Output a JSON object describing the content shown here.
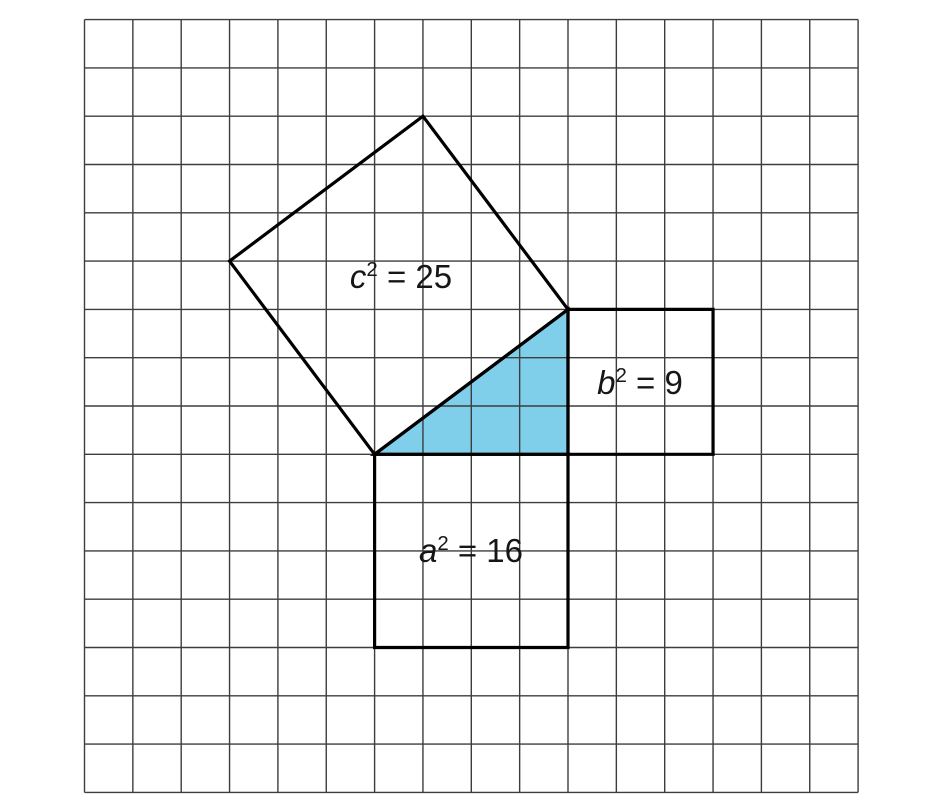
{
  "figure": {
    "grid": {
      "cols": 16,
      "rows": 16,
      "cell_w": 48.35,
      "cell_h": 48.3,
      "origin_x": 84.5,
      "origin_y": 19.6,
      "line_color": "#3d3d3d",
      "line_width": 1.4,
      "background": "#ffffff"
    },
    "style": {
      "outline_color": "#000000",
      "outline_width": 3.2,
      "triangle_fill": "#7FCFEA",
      "text_color": "#161616"
    },
    "shapes": {
      "c_square": [
        [
          6,
          9
        ],
        [
          3,
          5
        ],
        [
          7,
          2
        ],
        [
          10,
          6
        ]
      ],
      "b_square": [
        [
          10,
          6
        ],
        [
          13,
          6
        ],
        [
          13,
          9
        ],
        [
          10,
          9
        ]
      ],
      "a_square": [
        [
          6,
          9
        ],
        [
          10,
          9
        ],
        [
          10,
          13
        ],
        [
          6,
          13
        ]
      ],
      "triangle": [
        [
          6,
          9
        ],
        [
          10,
          6
        ],
        [
          10,
          9
        ]
      ]
    },
    "labels": [
      {
        "square": "c",
        "variable": "c",
        "exponent": "2",
        "equation": " = 25",
        "x": 401,
        "y": 277
      },
      {
        "square": "b",
        "variable": "b",
        "exponent": "2",
        "equation": " = 9",
        "x": 640,
        "y": 383
      },
      {
        "square": "a",
        "variable": "a",
        "exponent": "2",
        "equation": " = 16",
        "x": 471,
        "y": 551
      }
    ]
  }
}
